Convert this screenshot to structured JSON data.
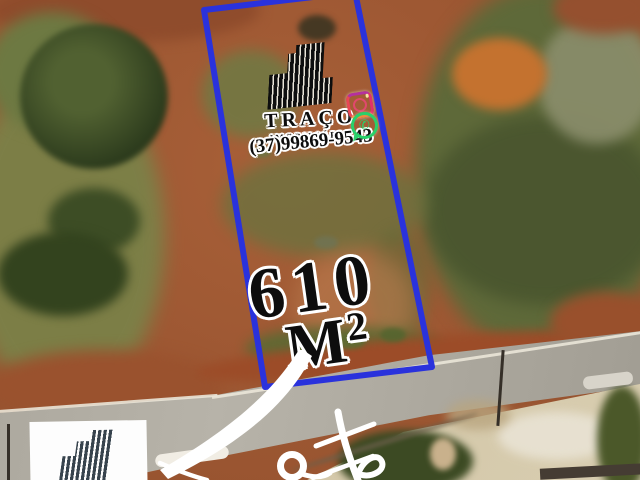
{
  "brand": {
    "name": "TRAÇO",
    "tagline": "IMOBILIÁRIA",
    "phone": "(37)99869-9543"
  },
  "listing": {
    "area_value": "610",
    "area_unit_letter": "M",
    "area_unit_exponent": "2",
    "caption": "Lote"
  },
  "icons": {
    "logo": "building-bars-icon",
    "instagram": "instagram-icon",
    "whatsapp": "whatsapp-icon",
    "footer_logo": "building-bars-icon"
  },
  "colors": {
    "lot_boundary": "#2a32dc",
    "instagram": "#e1306c",
    "whatsapp": "#2ad06a",
    "overlay_text": "#0d0d0d",
    "text_outline": "#ffffff",
    "badge_background": "#fdfdfd"
  }
}
